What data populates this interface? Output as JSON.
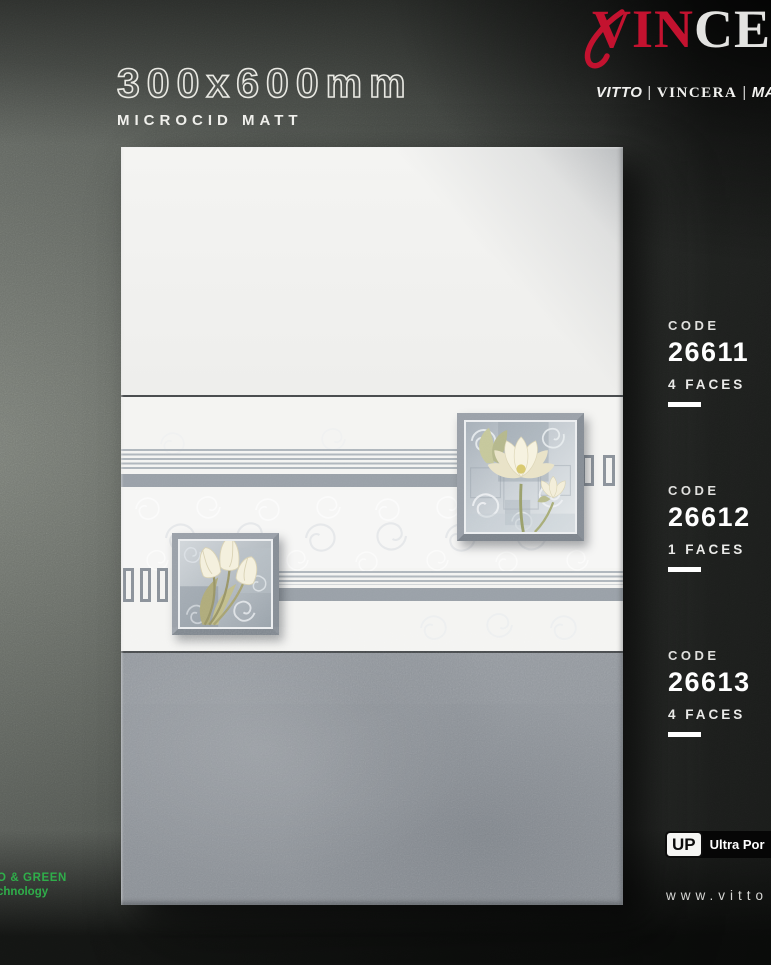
{
  "header": {
    "size_label": "300x600mm",
    "finish_label": "MICROCID MATT",
    "logo": {
      "red_part": "VIN",
      "light_part": "CE"
    },
    "subbrands": {
      "b1": "VITTO",
      "b2": "VINCERA",
      "b3": "MAX",
      "sep": "|"
    }
  },
  "specs": {
    "code_label": "CODE",
    "items": [
      {
        "code": "26611",
        "faces": "4 FACES"
      },
      {
        "code": "26612",
        "faces": "1 FACES"
      },
      {
        "code": "26613",
        "faces": "4 FACES"
      }
    ]
  },
  "footer": {
    "up_abbr": "UP",
    "up_text": "Ultra Por",
    "website": "www.vitto",
    "eco_line1": "O & GREEN",
    "eco_line2": "chnology"
  },
  "colors": {
    "brand_red": "#c3122f",
    "eco_green": "#2fae4a",
    "band_gray": "#9aa1a8",
    "tile_light": "#f2f2f0",
    "tile_gray": "#8f949a"
  }
}
